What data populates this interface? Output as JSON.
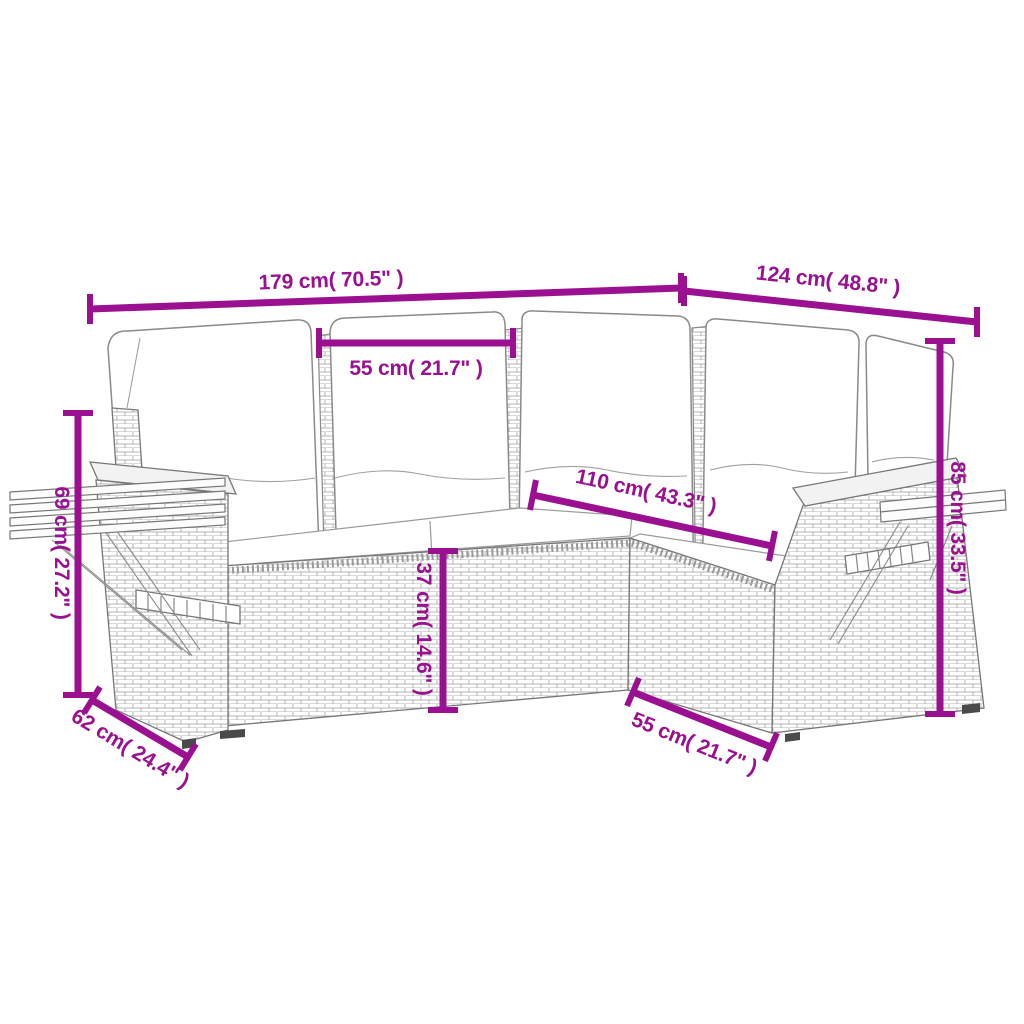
{
  "figure": {
    "subject": "corner-rattan-sofa-set-line-art",
    "style": "technical-dimension-diagram"
  },
  "colors": {
    "dimension_accent": "#9b0f91",
    "linework": "#8a8a8a",
    "background": "#ffffff"
  },
  "dims": [
    {
      "id": "total-width",
      "cm": 179,
      "inch": 70.5,
      "text": "179 cm( 70.5\" )"
    },
    {
      "id": "total-depth",
      "cm": 124,
      "inch": 48.8,
      "text": "124 cm( 48.8\" )"
    },
    {
      "id": "seat-width-top",
      "cm": 55,
      "inch": 21.7,
      "text": "55 cm( 21.7\" )"
    },
    {
      "id": "corner-span",
      "cm": 110,
      "inch": 43.3,
      "text": "110 cm( 43.3\" )"
    },
    {
      "id": "back-height",
      "cm": 85,
      "inch": 33.5,
      "text": "85 cm( 33.5\" )"
    },
    {
      "id": "arm-height",
      "cm": 69,
      "inch": 27.2,
      "text": "69 cm( 27.2\" )"
    },
    {
      "id": "seat-height",
      "cm": 37,
      "inch": 14.6,
      "text": "37 cm( 14.6\" )"
    },
    {
      "id": "side-shelf-depth",
      "cm": 62,
      "inch": 24.4,
      "text": "62 cm( 24.4\" )"
    },
    {
      "id": "seat-width-bottom",
      "cm": 55,
      "inch": 21.7,
      "text": "55 cm( 21.7\" )"
    }
  ]
}
